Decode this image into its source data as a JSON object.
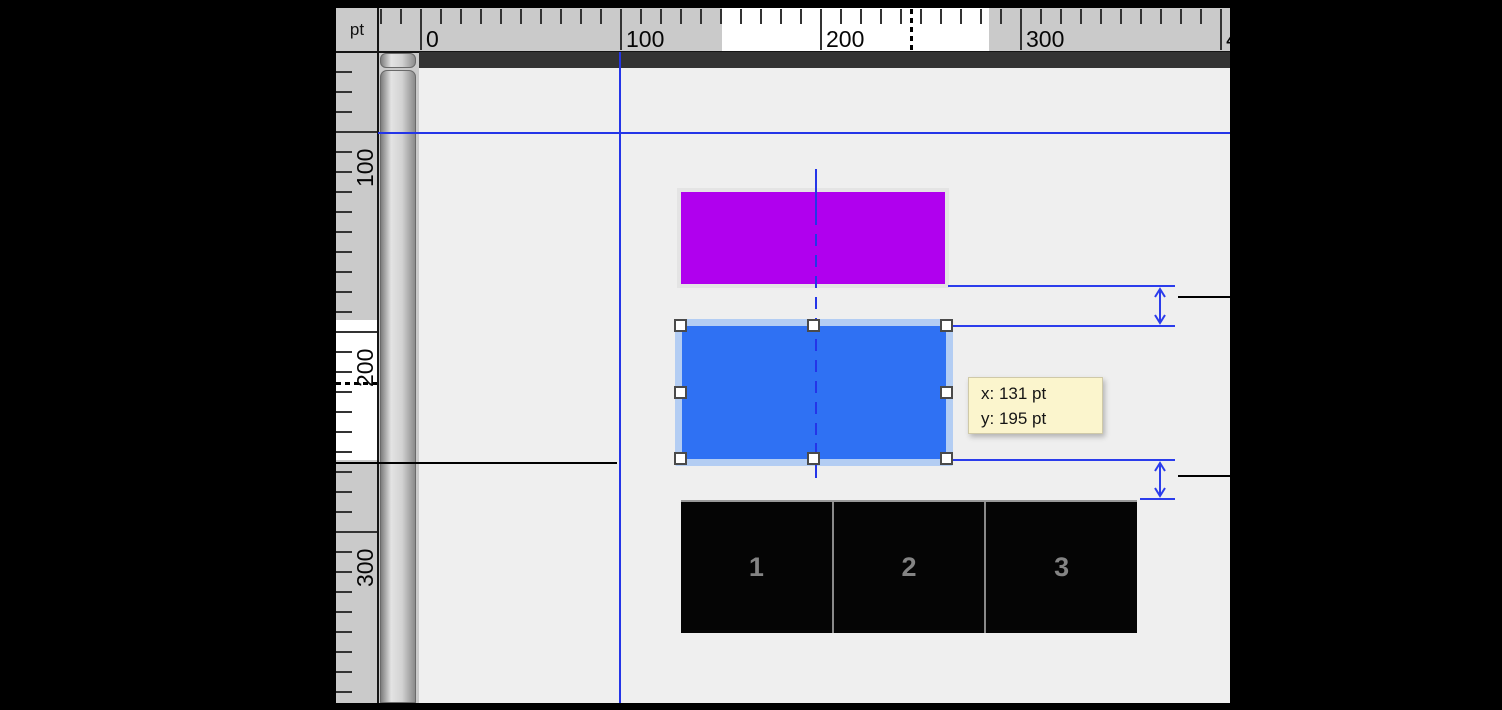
{
  "colors": {
    "frame": "#000000",
    "ruler_bg": "#cacaca",
    "ruler_highlight": "#ffffff",
    "tick": "#333333",
    "pasteboard": "#333333",
    "page": "#efefef",
    "guide_blue": "#2435e8",
    "dim_blue": "#2b3cec",
    "magenta_fill": "#b000ee",
    "blue_fill": "#2f71f3",
    "selection_halo": "#b3cdf3",
    "tooltip_bg": "#fbf5cd",
    "table_bg": "#050505",
    "table_divider": "#8a8a8a",
    "table_text": "#848484"
  },
  "ruler": {
    "unit": "pt",
    "h_labels": [
      {
        "text": "0",
        "px": 420
      },
      {
        "text": "100",
        "px": 620
      },
      {
        "text": "200",
        "px": 820
      },
      {
        "text": "300",
        "px": 1020
      },
      {
        "text": "400",
        "px": 1220
      }
    ],
    "v_labels": [
      {
        "text": "100",
        "py": 131
      },
      {
        "text": "200",
        "py": 331
      },
      {
        "text": "300",
        "py": 531
      }
    ]
  },
  "tooltip": {
    "line1": "x: 131 pt",
    "line2": "y: 195 pt"
  },
  "table": {
    "cells": [
      "1",
      "2",
      "3"
    ]
  }
}
